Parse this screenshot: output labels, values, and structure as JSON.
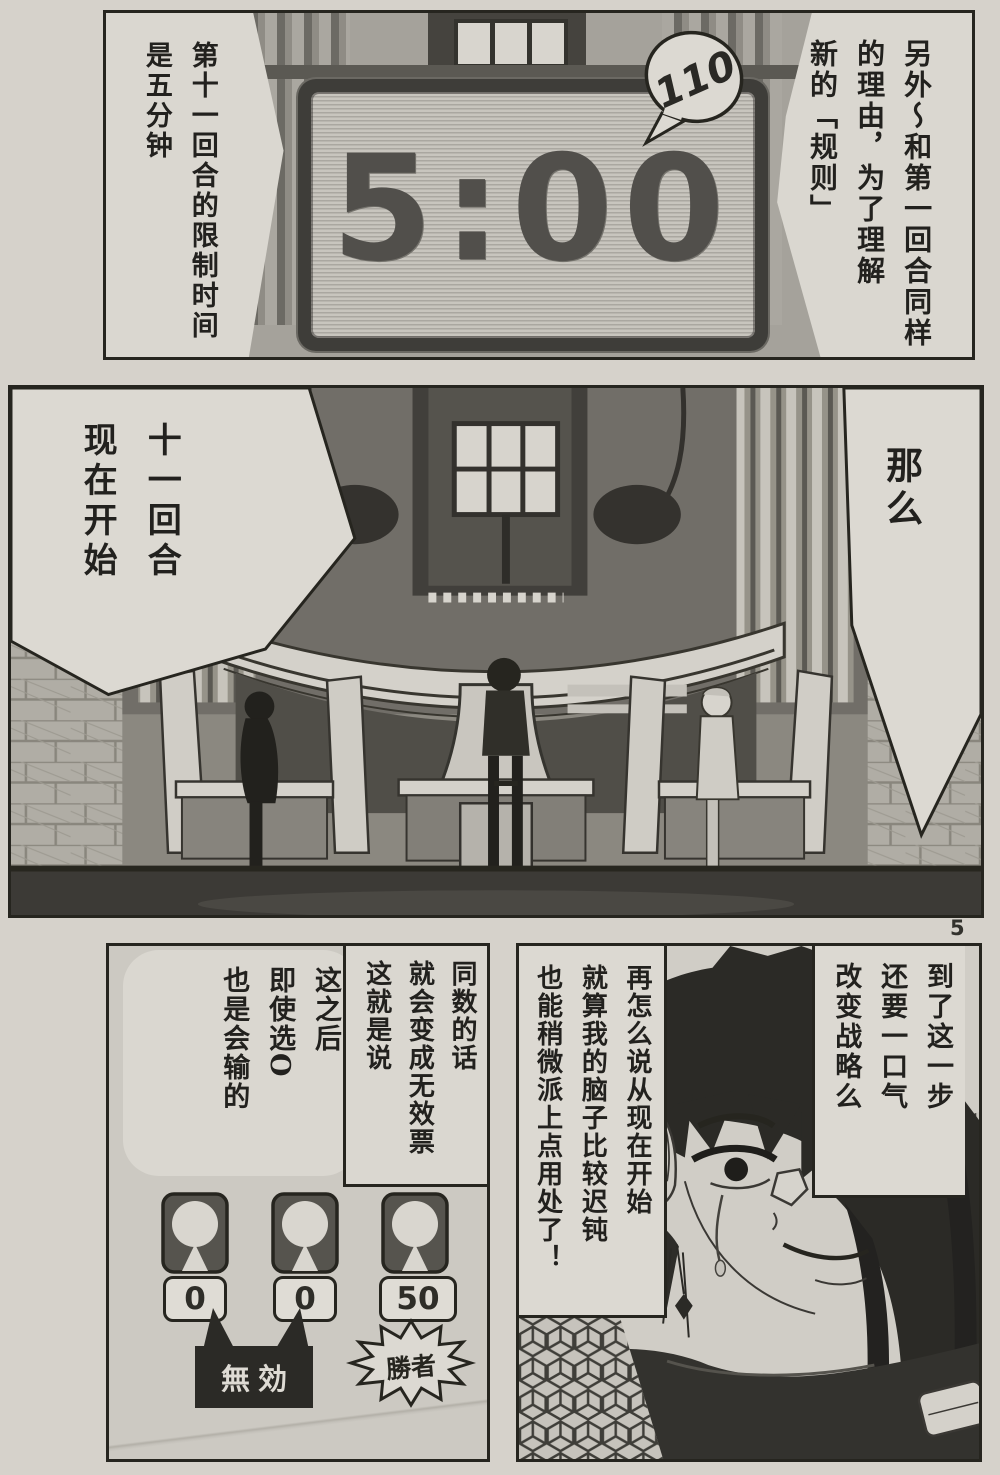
{
  "page": {
    "number": "5",
    "colors": {
      "paper": "#d6d2cb",
      "ink": "#26251f",
      "bubble": "#dcd9d2",
      "screen": "#c8c5be",
      "clock_digits": "#514f4b",
      "dark_box": "#2b2a26"
    }
  },
  "top_panel": {
    "narration_left": {
      "lines": [
        "第十一回合的限制时间",
        "是五分钟"
      ]
    },
    "narration_right": {
      "lines": [
        "另外〜和第一回合同样",
        "的理由，为了理解",
        "新的「规则」"
      ]
    },
    "clock": {
      "time": "5:00"
    },
    "sfx_bubble": {
      "text": "110"
    }
  },
  "middle_panel": {
    "bubble_left": {
      "lines": [
        "十一回合",
        "现在开始"
      ]
    },
    "bubble_right": {
      "lines": [
        "那么"
      ]
    }
  },
  "bottom_left_panel": {
    "bubble_main": {
      "lines": [
        "这之后",
        "即使选O",
        "也是会输的"
      ]
    },
    "bubble_inset": {
      "lines": [
        "同数的话",
        "就会变成无效票",
        "这就是说"
      ]
    },
    "counters": [
      {
        "icon": "person-icon",
        "value": "0"
      },
      {
        "icon": "person-icon",
        "value": "0"
      },
      {
        "icon": "person-icon",
        "value": "50"
      }
    ],
    "invalid_label": "無効",
    "winner_label": "勝者"
  },
  "bottom_right_panel": {
    "bubble_left": {
      "lines": [
        "再怎么说从现在开始",
        "就算我的脑子比较迟钝",
        "也能稍微派上点用处了！"
      ]
    },
    "bubble_right": {
      "lines": [
        "到了这一步",
        "还要一口气",
        "改变战略么"
      ]
    }
  }
}
